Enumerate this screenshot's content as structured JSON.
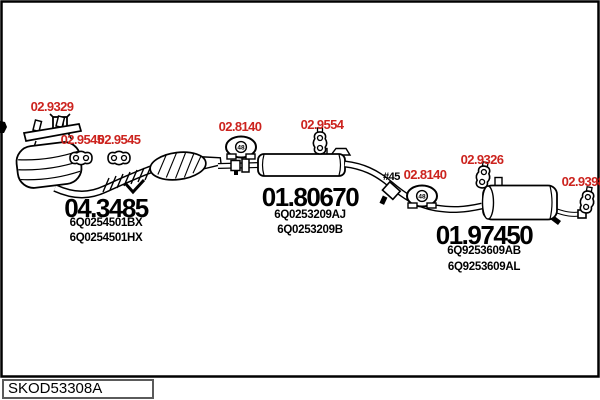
{
  "colors": {
    "part_label_red": "#cc231e",
    "ink": "#000000",
    "background": "#ffffff"
  },
  "footer": {
    "diagram_code": "SKOD53308A"
  },
  "clamp_note": "#45",
  "mount_marking": "48",
  "fittings": {
    "gasket_front": "02.9329",
    "hanger_front_left": "02.9545",
    "hanger_front_right": "02.9545",
    "mount_middle": "02.8140",
    "hanger_middle": "02.9554",
    "mount_rear": "02.8140",
    "hanger_rear": "02.9326",
    "hanger_tail": "02.9398"
  },
  "sections": {
    "front": {
      "code": "04.3485",
      "part_numbers": [
        "6Q0254501BX",
        "6Q0254501HX"
      ]
    },
    "middle": {
      "code": "01.80670",
      "part_numbers": [
        "6Q0253209AJ",
        "6Q0253209B"
      ]
    },
    "rear": {
      "code": "01.97450",
      "part_numbers": [
        "6Q9253609AB",
        "6Q9253609AL"
      ]
    }
  }
}
